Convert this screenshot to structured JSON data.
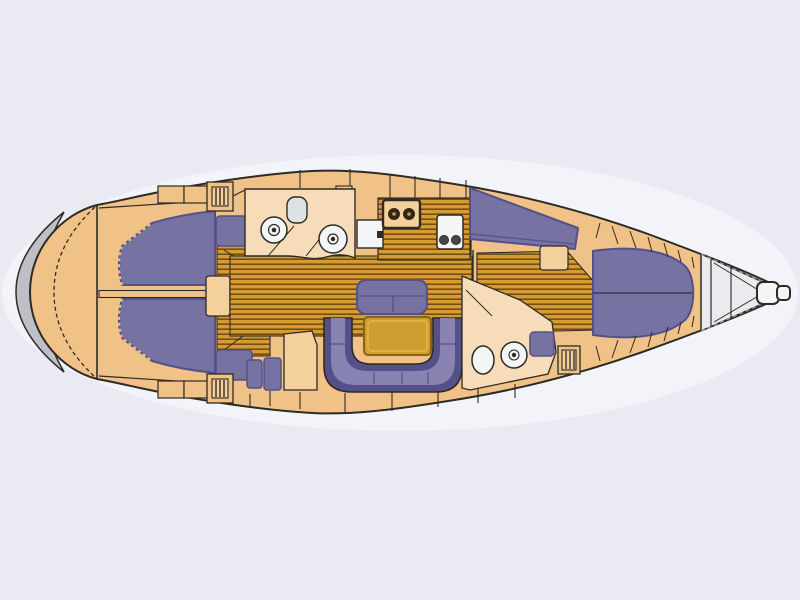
{
  "diagram": {
    "type": "sailing-yacht-deck-plan",
    "orientation": {
      "stern": "left",
      "bow": "right"
    },
    "features": [
      "swim-platform",
      "stern-deck",
      "aft-cabin-port-berth",
      "aft-cabin-starboard-berth",
      "companionway-steps",
      "aft-head",
      "galley",
      "chart-table",
      "salon-u-settee",
      "salon-center-bench",
      "salon-table",
      "forward-side-sofa",
      "forward-island-berth",
      "forward-head",
      "deck-hatches",
      "bow-deck",
      "bow-fitting"
    ],
    "fixtures": [
      "toilet",
      "washbasin",
      "shower",
      "stove-two-burners",
      "galley-sink",
      "fridge"
    ]
  },
  "palette": {
    "bg": "#e9eaf2",
    "glow": "#f3f4f9",
    "line": "#2e2a25",
    "hull": "#f1c287",
    "hull_light": "#f3d09c",
    "room": "#f6dcb8",
    "wood": "#d89b32",
    "wood_line": "#715011",
    "uph": "#7672a2",
    "uph_light": "#8883b1",
    "uph_dark": "#55508a",
    "table": "#cf9e31",
    "table_edge": "#8a6414",
    "fixture": "#f3f5f6",
    "fixture_gray": "#dde2e5",
    "platform": "#bfc0c7",
    "dash": "#8f9097",
    "burner": "#2f2619"
  }
}
